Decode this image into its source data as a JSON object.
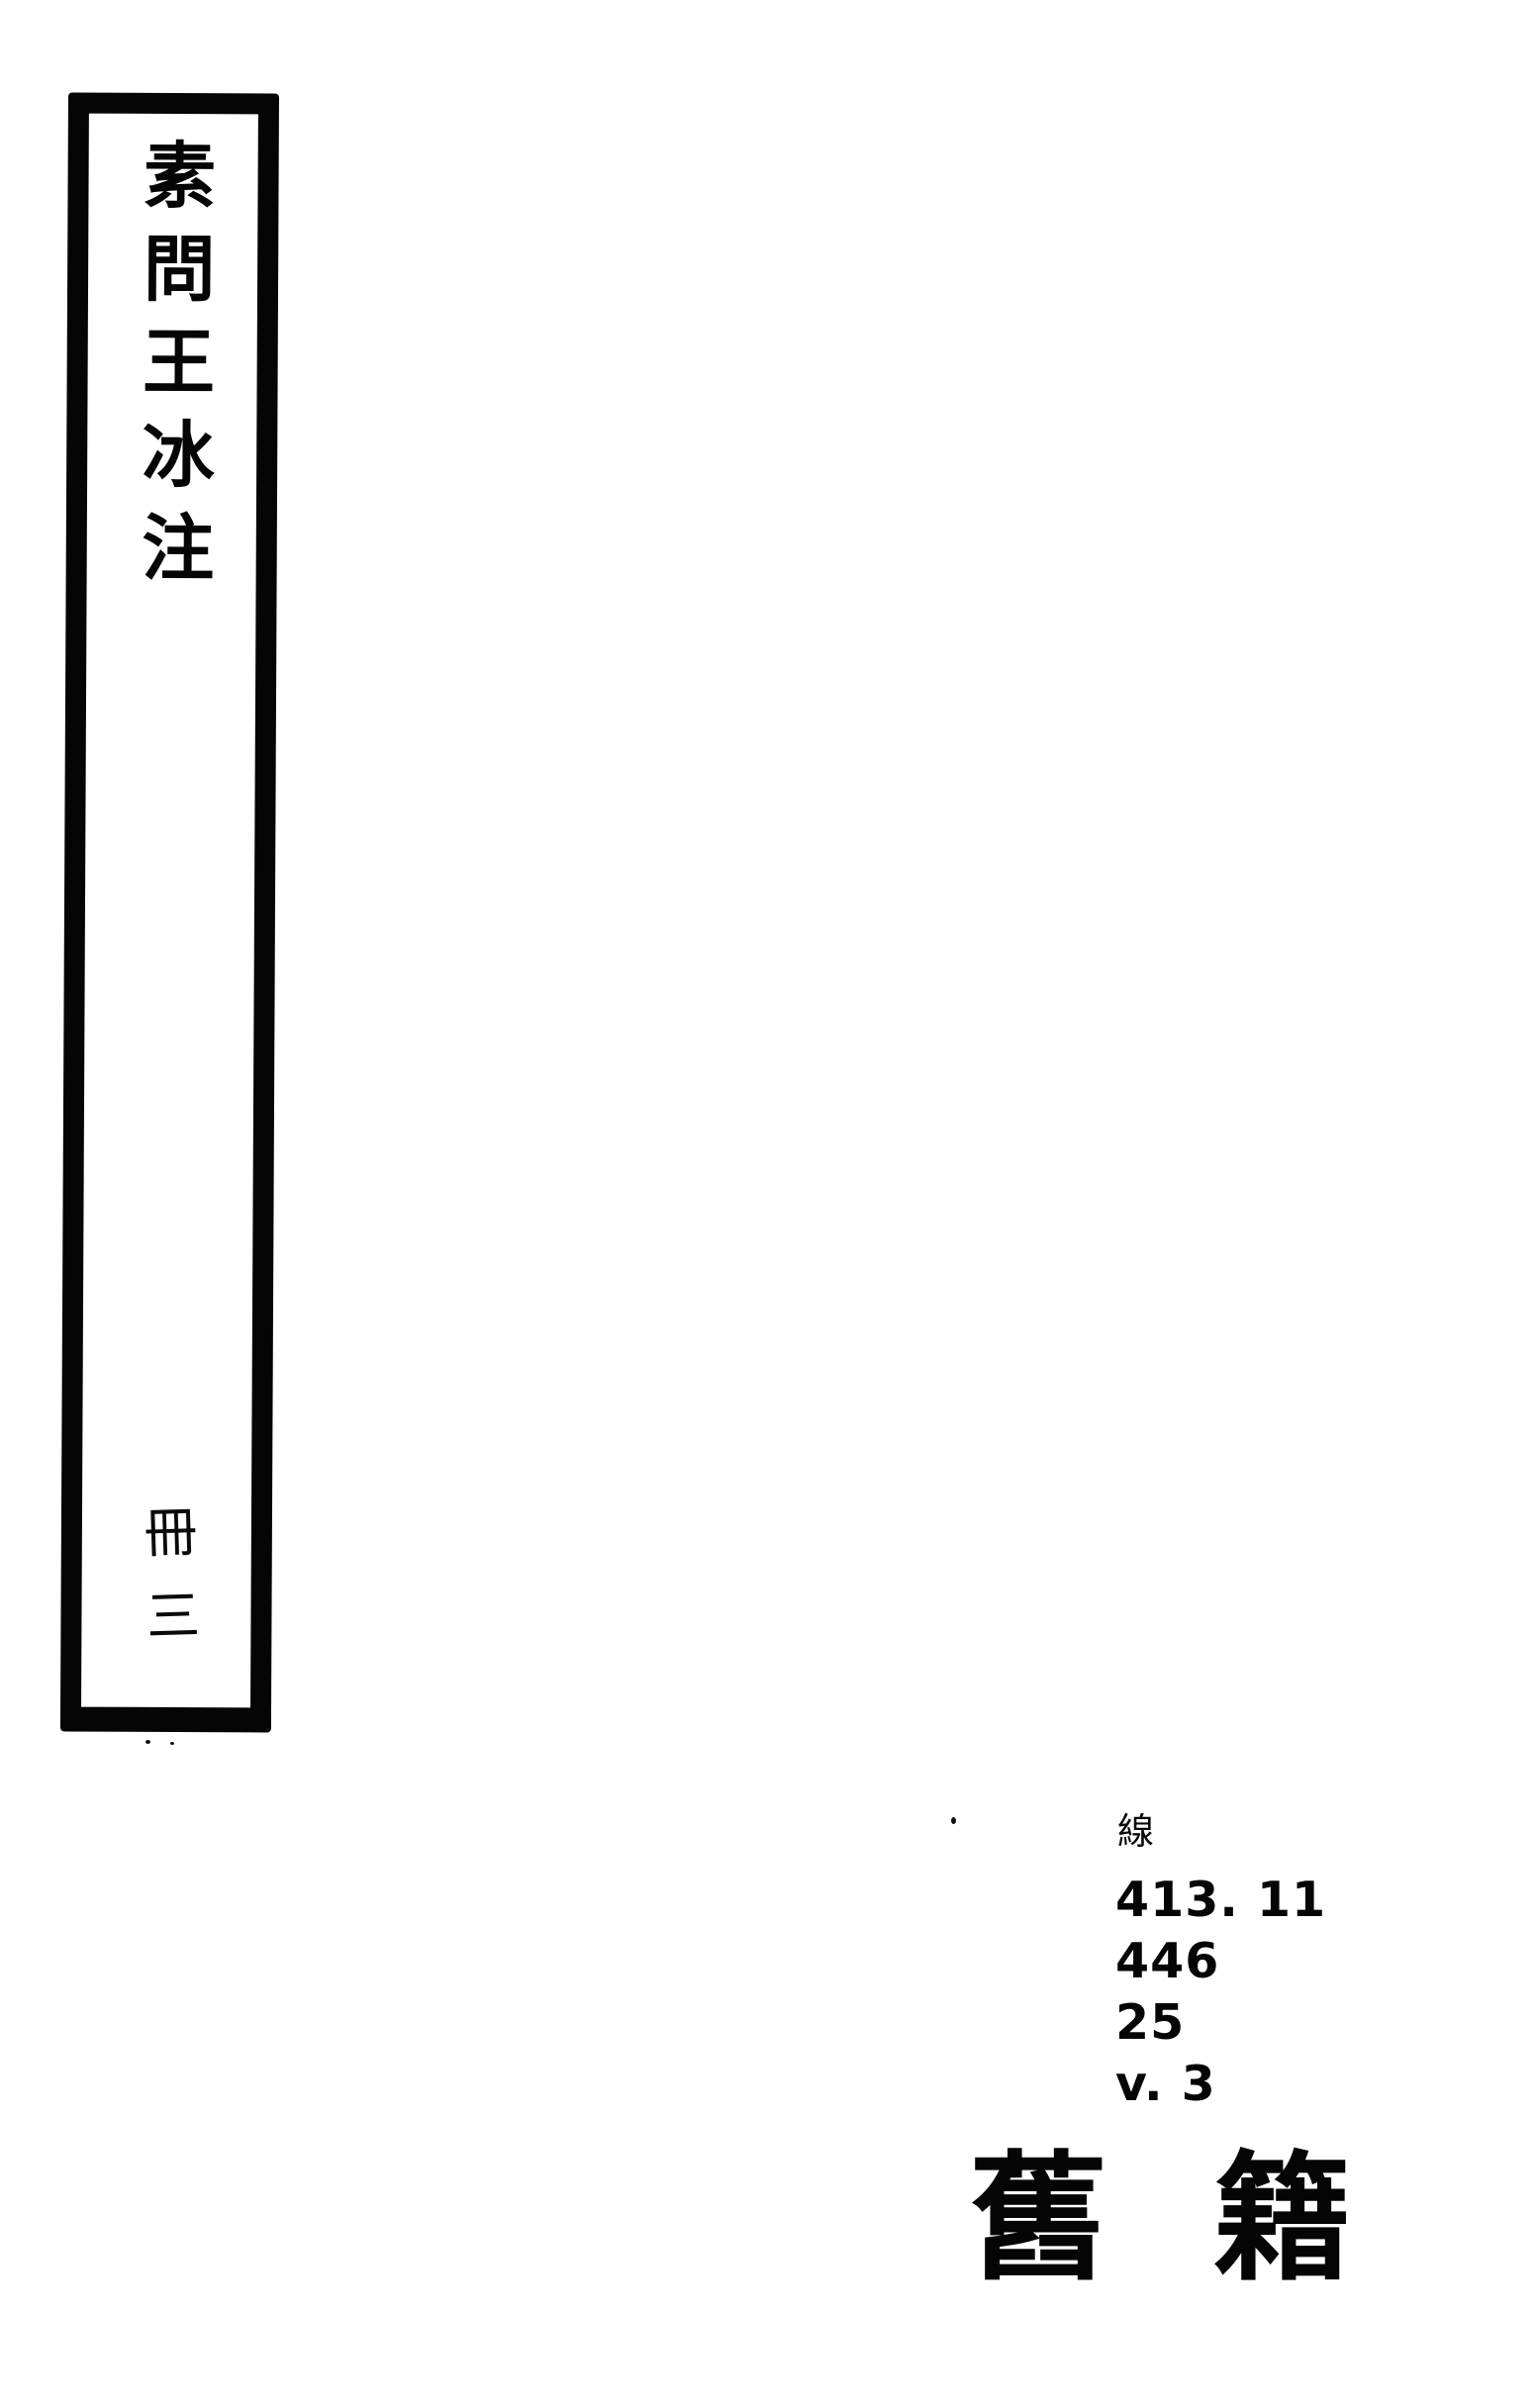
{
  "colors": {
    "paper": "#ffffff",
    "ink": "#050505"
  },
  "spine_label": {
    "title": "素問王冰注",
    "volume": "冊三"
  },
  "call_number": {
    "format_char": "線",
    "lines": [
      "413. 11",
      "446",
      "25",
      "v. 3"
    ]
  },
  "stamp": {
    "chars": [
      "舊",
      "籍"
    ]
  }
}
